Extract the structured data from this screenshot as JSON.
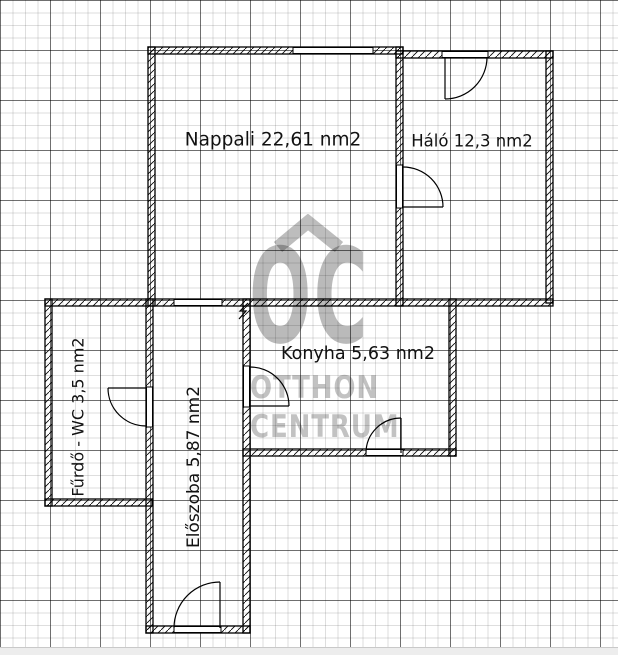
{
  "document": {
    "type": "apartment-floor-plan",
    "area_unit": "nm2"
  },
  "rooms": {
    "nappali": {
      "label": "Nappali 22,61 nm2"
    },
    "halo": {
      "label": "Háló 12,3 nm2"
    },
    "konyha": {
      "label": "Konyha 5,63 nm2"
    },
    "furdo": {
      "label": "Fűrdő - WC 3,5 nm2"
    },
    "eloszoba": {
      "label": "Előszoba 5,87 nm2"
    }
  },
  "watermark": {
    "logo": "OC",
    "line1": "OTTHON",
    "line2": "CENTRUM",
    "color": "rgba(0,0,0,0.26)"
  },
  "colors": {
    "wall_line": "#000000",
    "grid_minor": "#dddddd",
    "grid_major": "#777777",
    "background": "#ffffff",
    "label_text": "#111111"
  }
}
